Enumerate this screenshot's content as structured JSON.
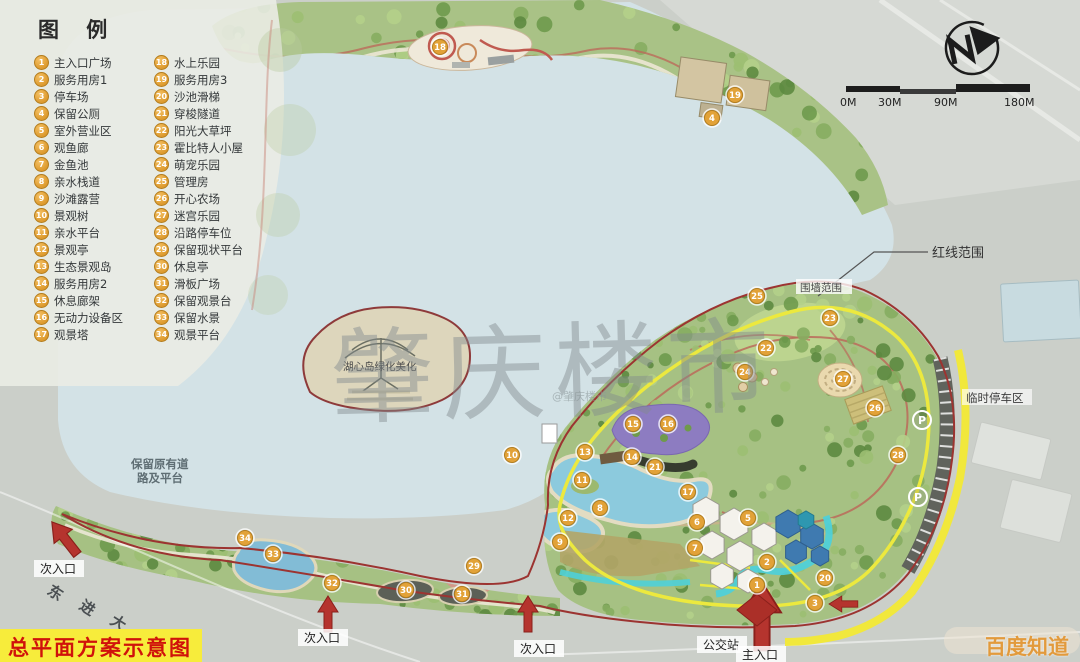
{
  "title": "总平面方案示意图",
  "legend": {
    "title": "图 例",
    "items": [
      {
        "num": 1,
        "label": "主入口广场"
      },
      {
        "num": 2,
        "label": "服务用房1"
      },
      {
        "num": 3,
        "label": "停车场"
      },
      {
        "num": 4,
        "label": "保留公厕"
      },
      {
        "num": 5,
        "label": "室外营业区"
      },
      {
        "num": 6,
        "label": "观鱼廊"
      },
      {
        "num": 7,
        "label": "金鱼池"
      },
      {
        "num": 8,
        "label": "亲水栈道"
      },
      {
        "num": 9,
        "label": "沙滩露营"
      },
      {
        "num": 10,
        "label": "景观树"
      },
      {
        "num": 11,
        "label": "亲水平台"
      },
      {
        "num": 12,
        "label": "景观亭"
      },
      {
        "num": 13,
        "label": "生态景观岛"
      },
      {
        "num": 14,
        "label": "服务用房2"
      },
      {
        "num": 15,
        "label": "休息廊架"
      },
      {
        "num": 16,
        "label": "无动力设备区"
      },
      {
        "num": 17,
        "label": "观景塔"
      },
      {
        "num": 18,
        "label": "水上乐园"
      },
      {
        "num": 19,
        "label": "服务用房3"
      },
      {
        "num": 20,
        "label": "沙池滑梯"
      },
      {
        "num": 21,
        "label": "穿梭隧道"
      },
      {
        "num": 22,
        "label": "阳光大草坪"
      },
      {
        "num": 23,
        "label": "霍比特人小屋"
      },
      {
        "num": 24,
        "label": "萌宠乐园"
      },
      {
        "num": 25,
        "label": "管理房"
      },
      {
        "num": 26,
        "label": "开心农场"
      },
      {
        "num": 27,
        "label": "迷宫乐园"
      },
      {
        "num": 28,
        "label": "沿路停车位"
      },
      {
        "num": 29,
        "label": "保留现状平台"
      },
      {
        "num": 30,
        "label": "休息亭"
      },
      {
        "num": 31,
        "label": "滑板广场"
      },
      {
        "num": 32,
        "label": "保留观景台"
      },
      {
        "num": 33,
        "label": "保留水景"
      },
      {
        "num": 34,
        "label": "观景平台"
      }
    ]
  },
  "scale_bar": {
    "labels": [
      "0M",
      "30M",
      "90M",
      "180M"
    ]
  },
  "annotations": {
    "red_line": "红线范围",
    "wall": "围墙范围",
    "temp_parking": "临时停车区",
    "keep_road_line1": "保留原有道",
    "keep_road_line2": "路及平台",
    "island": "湖心岛绿化美化",
    "road_name": "东进大道",
    "bus_stop": "公交站",
    "main_entrance": "主入口",
    "secondary_entrance": "次入口",
    "parking_symbol": "P"
  },
  "watermarks": {
    "center": "肇庆楼市",
    "small": "@肇庆楼市",
    "bottom_right": "百度知道"
  },
  "colors": {
    "lake": "#d3e2e6",
    "park_green": "#a6c183",
    "red_line": "#9c3431",
    "yellow_band": "#f1e83c",
    "badge": "#dd9a2e",
    "title_bg": "#f7ec3b",
    "title_text": "#d0120b",
    "watermark_orange": "#e29a3c"
  },
  "map": {
    "markers": [
      {
        "num": 18,
        "x": 440,
        "y": 47
      },
      {
        "num": 19,
        "x": 735,
        "y": 95
      },
      {
        "num": 4,
        "x": 712,
        "y": 118
      },
      {
        "num": 25,
        "x": 757,
        "y": 296
      },
      {
        "num": 23,
        "x": 830,
        "y": 318
      },
      {
        "num": 22,
        "x": 766,
        "y": 348
      },
      {
        "num": 24,
        "x": 745,
        "y": 372
      },
      {
        "num": 27,
        "x": 843,
        "y": 379
      },
      {
        "num": 26,
        "x": 875,
        "y": 408
      },
      {
        "num": 21,
        "x": 655,
        "y": 467
      },
      {
        "num": 15,
        "x": 633,
        "y": 424
      },
      {
        "num": 16,
        "x": 668,
        "y": 424
      },
      {
        "num": 13,
        "x": 585,
        "y": 452
      },
      {
        "num": 14,
        "x": 632,
        "y": 457
      },
      {
        "num": 10,
        "x": 512,
        "y": 455
      },
      {
        "num": 11,
        "x": 582,
        "y": 480
      },
      {
        "num": 12,
        "x": 568,
        "y": 518
      },
      {
        "num": 17,
        "x": 688,
        "y": 492
      },
      {
        "num": 6,
        "x": 697,
        "y": 522
      },
      {
        "num": 7,
        "x": 695,
        "y": 548
      },
      {
        "num": 5,
        "x": 748,
        "y": 518
      },
      {
        "num": 2,
        "x": 767,
        "y": 562
      },
      {
        "num": 8,
        "x": 600,
        "y": 508
      },
      {
        "num": 9,
        "x": 560,
        "y": 542
      },
      {
        "num": 20,
        "x": 825,
        "y": 578
      },
      {
        "num": 3,
        "x": 815,
        "y": 603
      },
      {
        "num": 1,
        "x": 757,
        "y": 585
      },
      {
        "num": 28,
        "x": 898,
        "y": 455
      },
      {
        "num": 34,
        "x": 245,
        "y": 538
      },
      {
        "num": 33,
        "x": 273,
        "y": 554
      },
      {
        "num": 32,
        "x": 332,
        "y": 583
      },
      {
        "num": 29,
        "x": 474,
        "y": 566
      },
      {
        "num": 30,
        "x": 406,
        "y": 590
      },
      {
        "num": 31,
        "x": 462,
        "y": 594
      }
    ],
    "parking_markers": [
      {
        "x": 922,
        "y": 420
      },
      {
        "x": 918,
        "y": 497
      }
    ]
  }
}
